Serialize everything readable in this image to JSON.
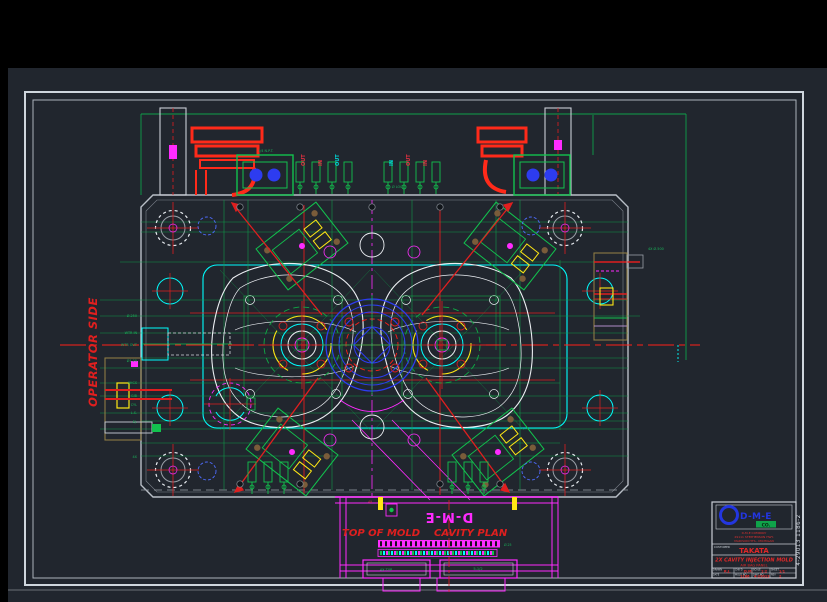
{
  "drawing": {
    "operator_side": "OPERATOR SIDE",
    "top_of_mold": "TOP OF MOLD",
    "cavity_plan": "CAVITY PLAN",
    "dme_logo_text": "D-M-E",
    "ports": [
      "OUT",
      "IN",
      "OUT",
      "IN",
      "OUT",
      "IN"
    ],
    "leader_labels_left": [
      "Ø.250",
      "WTR IN",
      "WTR OUT",
      "Ø1.25",
      "SHCS",
      "GIB",
      "CYL",
      "L.S.",
      "EJ.",
      "4X"
    ],
    "top_labels": [
      "1/4 N.P.T.",
      "Ø LOC."
    ],
    "right_label": "4X Ø.500",
    "bottom_labels": {
      "strip": "Ø.25",
      "foot_left": "4X TYP",
      "foot_right": "5-1/2",
      "pl": "4X"
    }
  },
  "frame": {
    "dwg_number_vertical": "4-29013 1186-2"
  },
  "title_block": {
    "logo_text": "D-M-E",
    "badge": "CO.",
    "address": [
      "D-M-E COMPANY",
      "29111 STEPHENSON HWY.",
      "MADISON HTS., MICHIGAN"
    ],
    "customer_label": "CUSTOMER",
    "customer": "TAKATA",
    "title": "2X CAVITY INJECTION MOLD",
    "subtitle": "AIR BAG PANEL",
    "fields": [
      {
        "label": "DRAWN",
        "value": "R.J."
      },
      {
        "label": "CHK'D",
        "value": "D.M."
      },
      {
        "label": "SCALE",
        "value": "1:2"
      },
      {
        "label": "SHEET",
        "value": "1/1"
      },
      {
        "label": "DATE",
        "value": ""
      },
      {
        "label": "MOLD NO",
        "value": "1186"
      },
      {
        "label": "DWG NO",
        "value": "4-29013"
      },
      {
        "label": "REV",
        "value": "2"
      }
    ]
  }
}
